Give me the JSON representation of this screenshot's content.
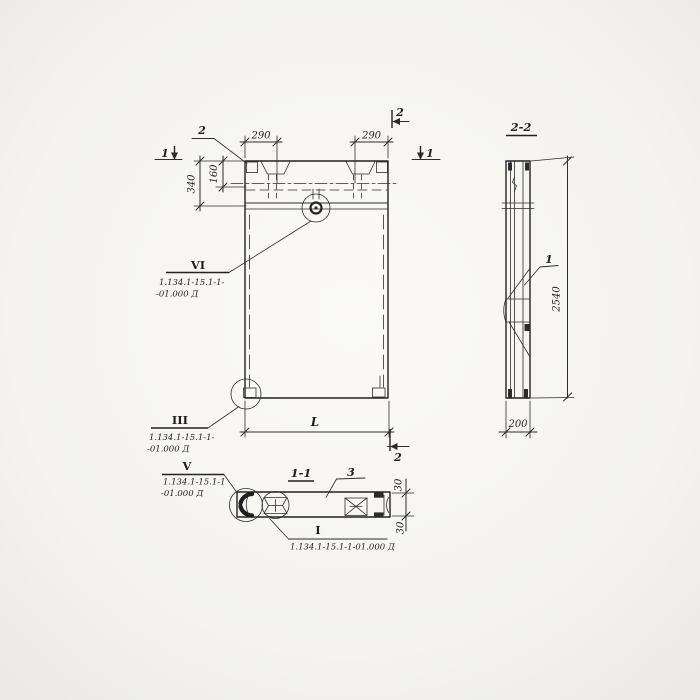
{
  "colors": {
    "ink": "#2c2c2c",
    "paper": "#f5f4f1"
  },
  "elevation": {
    "marker_1_left": "1",
    "marker_1_right": "1",
    "marker_2_top": "2",
    "marker_2_bottom": "2",
    "anchor_callout": "2",
    "dim_290_left": "290",
    "dim_290_right": "290",
    "dim_340": "340",
    "dim_160": "160",
    "dim_length": "L",
    "callout_vi": {
      "numeral": "VI",
      "ref1": "1.134.1-15.1-1-",
      "ref2": "-01.000 Д"
    },
    "callout_iii": {
      "numeral": "III",
      "ref1": "1.134.1-15.1-1-",
      "ref2": "-01.000 Д"
    }
  },
  "section_2_2": {
    "title": "2-2",
    "dim_height": "2540",
    "dim_width": "200",
    "callout_1": "1"
  },
  "section_1_1": {
    "title": "1-1",
    "callout_3": "3",
    "dim_30_top": "30",
    "dim_30_bottom": "30",
    "callout_v": {
      "numeral": "V",
      "ref1": "1.134.1-15.1-1",
      "ref2": "-01.000 Д"
    },
    "callout_i": {
      "numeral": "I",
      "ref": "1.134.1-15.1-1-01.000 Д"
    }
  }
}
